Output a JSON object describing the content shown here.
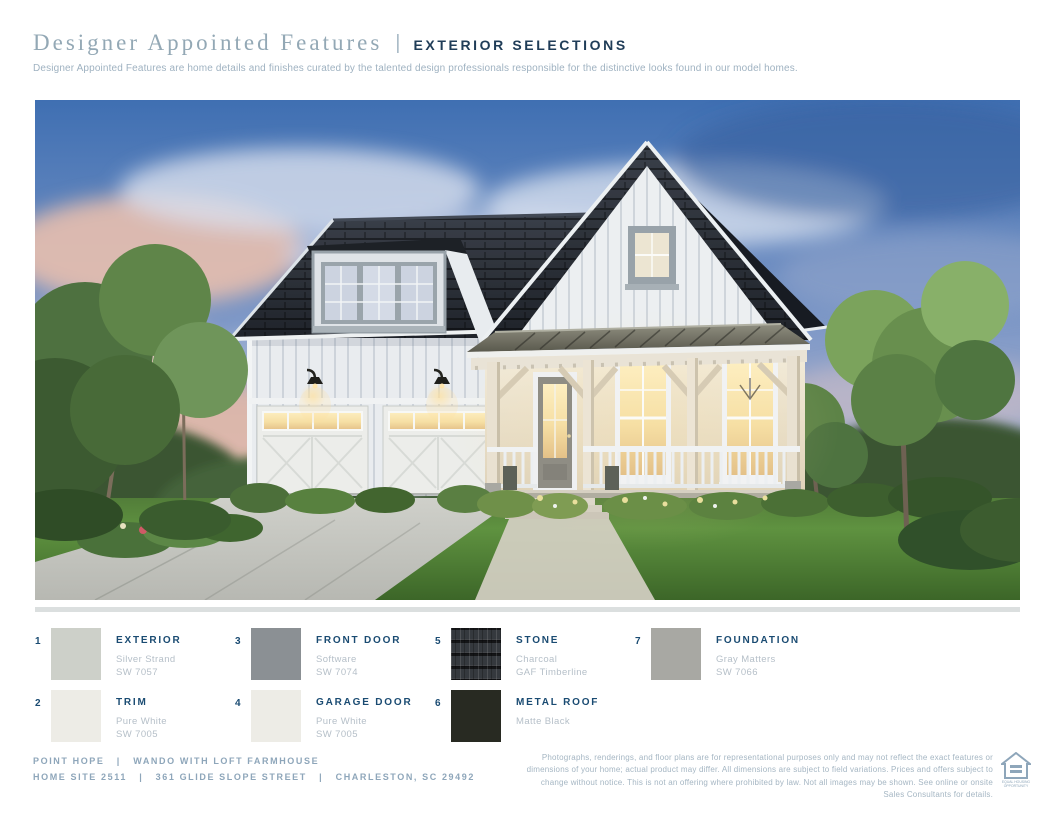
{
  "header": {
    "title": "Designer Appointed Features",
    "separator": "|",
    "subtitle": "EXTERIOR SELECTIONS",
    "description": "Designer Appointed Features are home details and finishes curated by the talented design professionals responsible for the distinctive looks found in our model homes."
  },
  "colors": {
    "title_blue": "#93a8b5",
    "header_navy": "#203d58",
    "description_gray": "#9fb2c1",
    "label_navy": "#1a4b72",
    "sub_gray": "#b5bfc8",
    "footer_blue": "#8ea6ba",
    "disclaimer_gray": "#a5b6c3",
    "divider_gray": "#dbdfdf",
    "page_bg": "#ffffff"
  },
  "legend": {
    "items": [
      {
        "number": "1",
        "label": "EXTERIOR",
        "name": "Silver Strand",
        "code": "SW 7057",
        "color": "#cdd0c9"
      },
      {
        "number": "2",
        "label": "TRIM",
        "name": "Pure White",
        "code": "SW 7005",
        "color": "#edece6"
      },
      {
        "number": "3",
        "label": "FRONT DOOR",
        "name": "Software",
        "code": "SW 7074",
        "color": "#8b9094"
      },
      {
        "number": "4",
        "label": "GARAGE DOOR",
        "name": "Pure White",
        "code": "SW 7005",
        "color": "#edece6"
      },
      {
        "number": "5",
        "label": "STONE",
        "name": "Charcoal",
        "code": "GAF Timberline",
        "color": "#2d3033"
      },
      {
        "number": "6",
        "label": "METAL ROOF",
        "name": "Matte Black",
        "code": "",
        "color": "#282a22"
      },
      {
        "number": "7",
        "label": "FOUNDATION",
        "name": "Gray Matters",
        "code": "SW 7066",
        "color": "#a8a8a3"
      }
    ]
  },
  "footer": {
    "community_line": "POINT HOPE   |   WANDO WITH LOFT FARMHOUSE",
    "address_line": "HOME SITE 2511   |   361 GLIDE SLOPE STREET   |   CHARLESTON, SC 29492",
    "disclaimer": "Photographs, renderings, and floor plans are for representational purposes only and may not reflect the exact features or dimensions of your home; actual product may differ. All dimensions are subject to field variations. Prices and offers subject to change without notice. This is not an offering where prohibited by law. Not all images may be shown. See online or onsite Sales Consultants for details.",
    "equal_housing": {
      "line1": "EQUAL HOUSING",
      "line2": "OPPORTUNITY"
    }
  }
}
